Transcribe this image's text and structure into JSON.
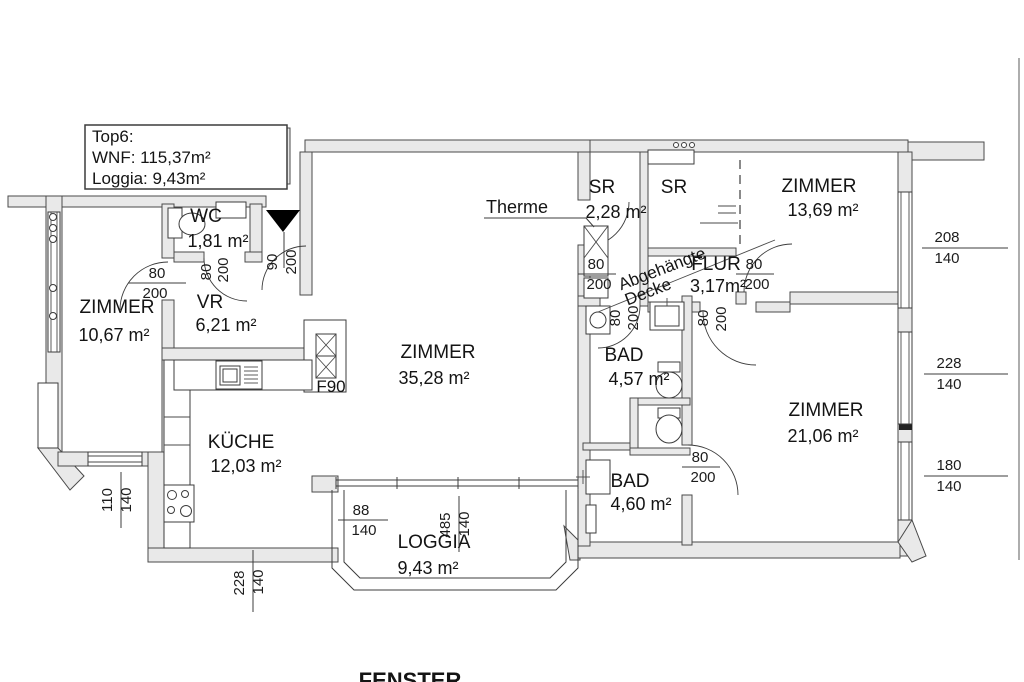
{
  "title_box": {
    "line1": "Top6:",
    "line2": "WNF: 115,37m²",
    "line3": "Loggia: 9,43m²"
  },
  "rooms": {
    "zimmer_left": {
      "label": "ZIMMER",
      "area": "10,67 m²"
    },
    "wc": {
      "label": "WC",
      "area": "1,81 m²"
    },
    "vr": {
      "label": "VR",
      "area": "6,21 m²"
    },
    "zimmer_main": {
      "label": "ZIMMER",
      "area": "35,28 m²"
    },
    "kueche": {
      "label": "KÜCHE",
      "area": "12,03 m²"
    },
    "loggia": {
      "label": "LOGGIA",
      "area": "9,43 m²"
    },
    "sr_small": {
      "label": "SR",
      "area": "2,28 m²"
    },
    "sr_large": {
      "label": "SR"
    },
    "zimmer_top_right": {
      "label": "ZIMMER",
      "area": "13,69 m²"
    },
    "flur": {
      "label": "FLUR",
      "area": "3,17m²"
    },
    "bad_upper": {
      "label": "BAD",
      "area": "4,57 m²"
    },
    "bad_lower": {
      "label": "BAD",
      "area": "4,60 m²"
    },
    "zimmer_right": {
      "label": "ZIMMER",
      "area": "21,06 m²"
    }
  },
  "annotations": {
    "therme": "Therme",
    "suspended_ceiling_line1": "Abgehängte",
    "suspended_ceiling_line2": "Decke",
    "fire_rating": "F90",
    "footer": "FENSTER"
  },
  "dimensions": {
    "entrance_door": {
      "w": "90",
      "h": "200"
    },
    "wc_door": {
      "w": "80",
      "h": "200"
    },
    "vr_door": {
      "w": "80",
      "h": "200"
    },
    "sr_door": {
      "w": "80",
      "h": "200"
    },
    "zimmer_top_right_door": {
      "w": "80",
      "h": "200"
    },
    "bad_upper_door": {
      "w": "80",
      "h": "200"
    },
    "zimmer_right_door": {
      "w": "80",
      "h": "200"
    },
    "bad_lower_door": {
      "w": "80",
      "h": "200"
    },
    "window_right_top": {
      "w": "208",
      "h": "140"
    },
    "window_right_middle": {
      "w": "228",
      "h": "140"
    },
    "window_right_bottom": {
      "w": "180",
      "h": "140"
    },
    "window_left": {
      "w": "110",
      "h": "140"
    },
    "window_loggia_west": {
      "w": "88",
      "h": "140"
    },
    "window_loggia_south": {
      "w": "485",
      "h": "140"
    },
    "window_bottom_left": {
      "w": "228",
      "h": "140"
    }
  }
}
